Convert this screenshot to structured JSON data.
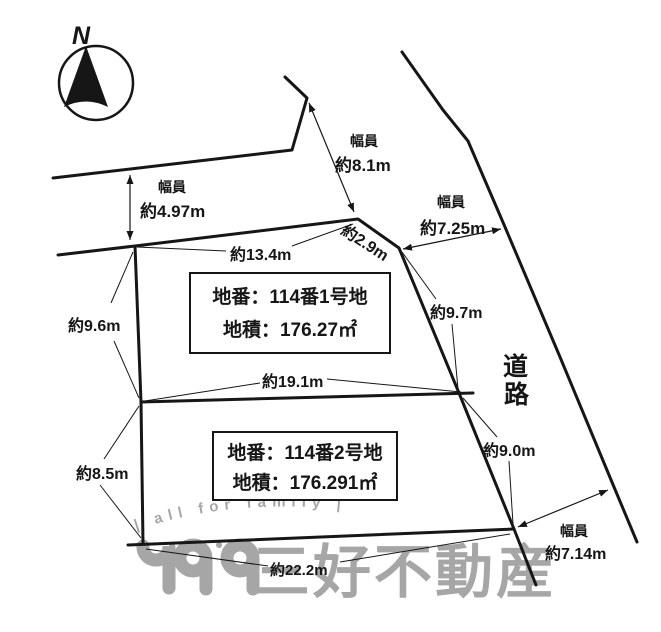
{
  "diagram": {
    "compass_label": "N",
    "road_label": {
      "char_top": "道",
      "char_bottom": "路"
    },
    "parcels": [
      {
        "lot": "地番：114番1号地",
        "area": "地積：176.27㎡"
      },
      {
        "lot": "地番：114番2号地",
        "area": "地積：176.291㎡"
      }
    ],
    "measurements": {
      "road_top_width": {
        "label": "幅員",
        "value": "約4.97m"
      },
      "junction_width": {
        "label": "幅員",
        "value": "約8.1m"
      },
      "road_right_width_top": {
        "label": "幅員",
        "value": "約7.25m"
      },
      "road_right_width_bottom": {
        "label": "幅員",
        "value": "約7.14m"
      },
      "parcel1_top_edge": "約13.4m",
      "junction_edge": "約2.9m",
      "parcel1_left_edge": "約9.6m",
      "divider_edge": "約19.1m",
      "parcel1_road_edge": "約9.7m",
      "parcel2_road_edge": "約9.0m",
      "parcel2_left_edge": "約8.5m",
      "parcel2_bottom_edge": "約22.2m"
    }
  },
  "watermark": {
    "slogan": "| all for family |",
    "company": "三好不動産"
  },
  "colors": {
    "line": "#161616",
    "watermark": "#a6a6a6",
    "background": "#ffffff"
  }
}
